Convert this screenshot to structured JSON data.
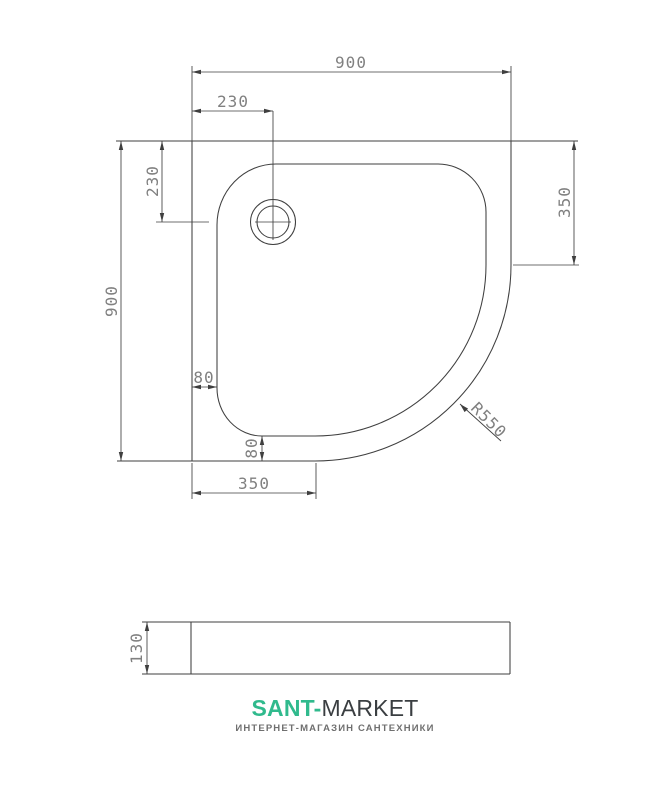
{
  "drawing": {
    "title_semantic": "quarter-round shower tray technical drawing",
    "top_view": {
      "dim_width": "900",
      "dim_drain_x": "230",
      "dim_drain_y": "230",
      "dim_height": "900",
      "dim_right_edge": "350",
      "dim_rim_left": "80",
      "dim_rim_bottom": "80",
      "dim_bottom_edge": "350",
      "dim_corner_radius": "R550"
    },
    "side_view": {
      "dim_depth": "130"
    }
  },
  "footer": {
    "brand_primary": "SANT-",
    "brand_secondary": "MARKET",
    "tagline": "ИНТЕРНЕТ-МАГАЗИН САНТЕХНИКИ"
  },
  "colors": {
    "line": "#3f3f3f",
    "dim_text": "#808080",
    "brand_green": "#30ba8d",
    "brand_dark": "#3a3e41",
    "tagline_gray": "#6f6f6f"
  }
}
